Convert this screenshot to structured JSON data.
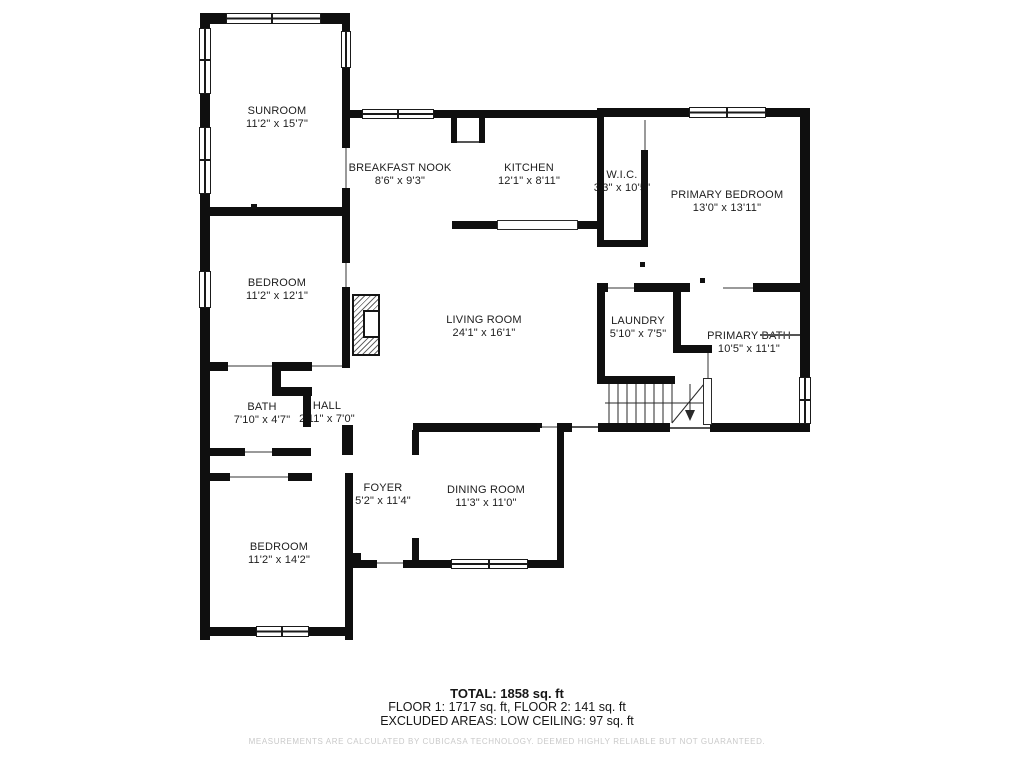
{
  "rooms": [
    {
      "name": "SUNROOM",
      "dims": "11'2\" x 15'7\""
    },
    {
      "name": "BREAKFAST NOOK",
      "dims": "8'6\" x 9'3\""
    },
    {
      "name": "KITCHEN",
      "dims": "12'1\" x 8'11\""
    },
    {
      "name": "W.I.C.",
      "dims": "3'3\" x 10'5\""
    },
    {
      "name": "PRIMARY BEDROOM",
      "dims": "13'0\" x 13'11\""
    },
    {
      "name": "BEDROOM",
      "dims": "11'2\" x 12'1\""
    },
    {
      "name": "LIVING ROOM",
      "dims": "24'1\" x 16'1\""
    },
    {
      "name": "LAUNDRY",
      "dims": "5'10\" x 7'5\""
    },
    {
      "name": "PRIMARY BATH",
      "dims": "10'5\" x 11'1\""
    },
    {
      "name": "BATH",
      "dims": "7'10\" x 4'7\""
    },
    {
      "name": "HALL",
      "dims": "2'11\" x 7'0\""
    },
    {
      "name": "FOYER",
      "dims": "5'2\" x 11'4\""
    },
    {
      "name": "DINING ROOM",
      "dims": "11'3\" x 11'0\""
    },
    {
      "name": "BEDROOM",
      "dims": "11'2\" x 14'2\""
    }
  ],
  "footer": {
    "total": "TOTAL: 1858 sq. ft",
    "floors": "FLOOR 1: 1717 sq. ft, FLOOR 2: 141 sq. ft",
    "excluded": "EXCLUDED AREAS: LOW CEILING: 97 sq. ft",
    "disclaimer": "MEASUREMENTS ARE CALCULATED BY CUBICASA TECHNOLOGY. DEEMED HIGHLY RELIABLE BUT NOT GUARANTEED."
  }
}
